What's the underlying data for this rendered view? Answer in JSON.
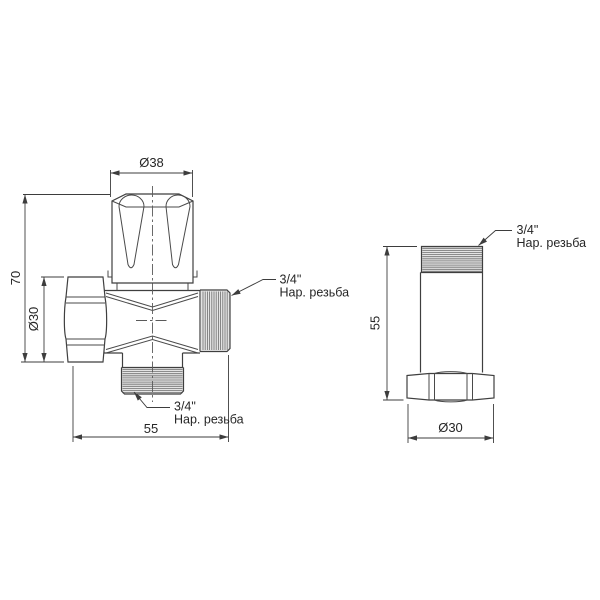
{
  "drawing": {
    "background": "#ffffff",
    "line_color": "#3f3f3f",
    "thread_fill": "#e4e4e4",
    "front_view": {
      "dim_handle_diameter": "Ø38",
      "dim_total_height": "70",
      "dim_nut_diameter": "Ø30",
      "dim_total_width": "55",
      "callout_side_thread": {
        "size": "3/4\"",
        "label": "Нар. резьба"
      },
      "callout_bottom_thread": {
        "size": "3/4\"",
        "label": "Нар. резьба"
      }
    },
    "side_view": {
      "dim_total_height": "55",
      "dim_nut_diameter": "Ø30",
      "callout_top_thread": {
        "size": "3/4\"",
        "label": "Нар. резьба"
      }
    }
  }
}
